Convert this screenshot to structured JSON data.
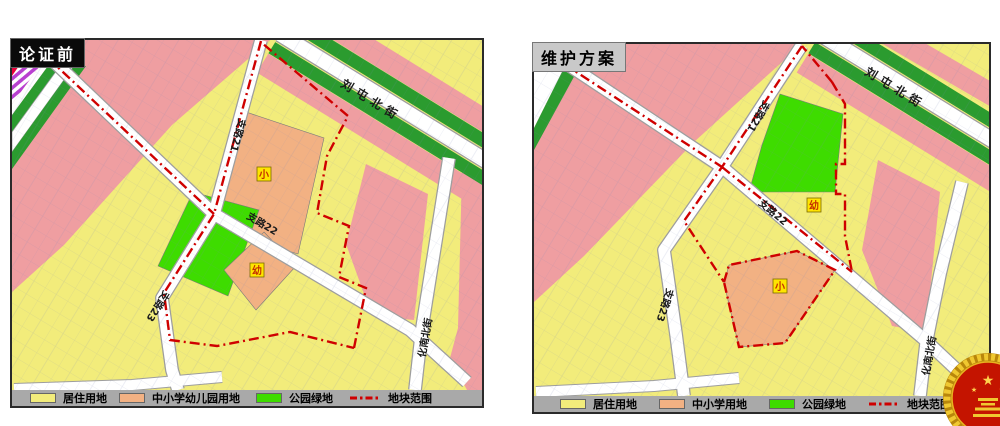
{
  "page": {
    "width": 1000,
    "height": 426,
    "background": "#FFFFFF"
  },
  "colors": {
    "residential": "#F2EC7B",
    "school_orange": "#F2B183",
    "park_green": "#3EDC00",
    "corridor_green": "#2B9B2F",
    "road_pink": "#EF9EA1",
    "road_white": "#FFFFFF",
    "boundary_red": "#CF0000",
    "badge_bg": "#FFE400",
    "badge_text": "#C43000",
    "legend_bar": "#A9A9A9"
  },
  "icons": {
    "emblem": "national-emblem-seal"
  },
  "maps": {
    "left": {
      "title": "论证前",
      "streets": {
        "liutun_north_street": "刘屯北街",
        "branch_21": "支路21",
        "branch_22": "支路22",
        "branch_23": "支路23",
        "huanan_north_street": "化南北街"
      },
      "badges": {
        "primary_school": "小",
        "kindergarten": "幼"
      },
      "legend": [
        {
          "label": "居住用地",
          "swatch": "fill",
          "color": "#F2EC7B"
        },
        {
          "label": "中小学幼儿园用地",
          "swatch": "fill",
          "color": "#F2B183"
        },
        {
          "label": "公园绿地",
          "swatch": "fill",
          "color": "#3EDC00"
        },
        {
          "label": "地块范围",
          "swatch": "dashdot-line",
          "color": "#CF0000"
        }
      ]
    },
    "right": {
      "title": "维护方案",
      "streets": {
        "liutun_north_street": "刘屯北街",
        "branch_21": "支路21",
        "branch_22": "支路22",
        "branch_23": "支路23",
        "huanan_north_street": "化南北街"
      },
      "badges": {
        "primary_school": "小",
        "kindergarten": "幼"
      },
      "legend": [
        {
          "label": "居住用地",
          "swatch": "fill",
          "color": "#F2EC7B"
        },
        {
          "label": "中小学用地",
          "swatch": "fill",
          "color": "#F2B183"
        },
        {
          "label": "公园绿地",
          "swatch": "fill",
          "color": "#3EDC00"
        },
        {
          "label": "地块范围",
          "swatch": "dashdot-line",
          "color": "#CF0000"
        }
      ]
    }
  }
}
